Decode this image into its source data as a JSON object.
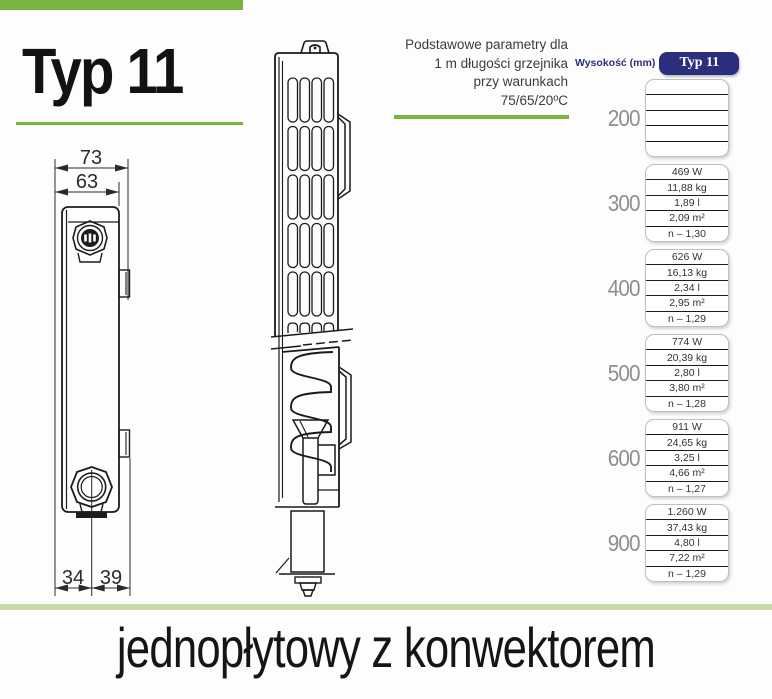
{
  "title": "Typ 11",
  "params_note": [
    "Podstawowe parametry dla",
    "1 m długości grzejnika",
    "przy warunkach",
    "75/65/20ºC"
  ],
  "drawing_dims": {
    "outer_width": "73",
    "inner_width": "63",
    "bottom_left": "34",
    "bottom_right": "39"
  },
  "table": {
    "height_header": "Wysokość (mm)",
    "type_header": "Typ 11",
    "rows": [
      {
        "height": "200",
        "values": [
          "",
          "",
          "",
          "",
          ""
        ]
      },
      {
        "height": "300",
        "values": [
          "469 W",
          "11,88 kg",
          "1,89 l",
          "2,09 m²",
          "n – 1,30"
        ]
      },
      {
        "height": "400",
        "values": [
          "626 W",
          "16,13 kg",
          "2,34 l",
          "2,95 m²",
          "n – 1,29"
        ]
      },
      {
        "height": "500",
        "values": [
          "774 W",
          "20,39 kg",
          "2,80 l",
          "3,80 m²",
          "n – 1,28"
        ]
      },
      {
        "height": "600",
        "values": [
          "911 W",
          "24,65 kg",
          "3,25 l",
          "4,66 m²",
          "n – 1,27"
        ]
      },
      {
        "height": "900",
        "values": [
          "1.260 W",
          "37,43 kg",
          "4,80 l",
          "7,22 m²",
          "n – 1,29"
        ]
      }
    ]
  },
  "footer_caption": "jednopłytowy z konwektorem",
  "colors": {
    "green_accent": "#7ab440",
    "green_pale": "#c8dba6",
    "navy_badge": "#2b2d7d",
    "gray_height_label": "#8e8e8e"
  }
}
